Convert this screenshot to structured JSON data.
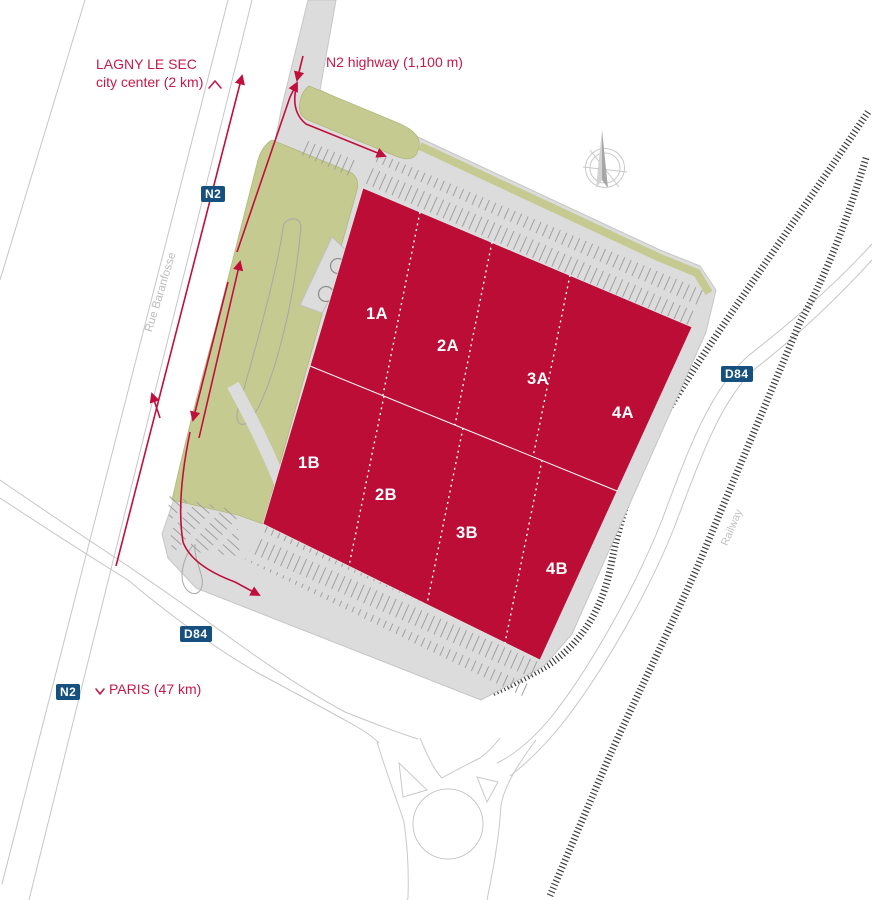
{
  "map": {
    "labels": {
      "north_destination": {
        "line1": "LAGNY LE SEC",
        "line2": "city center (2 km)"
      },
      "highway_access": "N2 highway (1,100 m)",
      "south_destination": "PARIS (47 km)",
      "street": "Rue Baranfosse",
      "railway": "Railway"
    },
    "badges": [
      {
        "id": "n2-upper",
        "label": "N2"
      },
      {
        "id": "d84-east",
        "label": "D84"
      },
      {
        "id": "d84-west",
        "label": "D84"
      },
      {
        "id": "n2-lower",
        "label": "N2"
      }
    ],
    "units": [
      "1A",
      "2A",
      "3A",
      "4A",
      "1B",
      "2B",
      "3B",
      "4B"
    ],
    "colors": {
      "building_crimson": "#bb0d35",
      "accent_crimson": "#c41a4a",
      "landscape_green": "#c5ca90",
      "site_gray": "#dcdcdc",
      "road_line_gray": "#c6c6c6",
      "parking_line_gray": "#a0a0a0",
      "railway_dark": "#3d3d3d",
      "badge_blue": "#15507e",
      "muted_text_gray": "#bcbcbc"
    }
  }
}
